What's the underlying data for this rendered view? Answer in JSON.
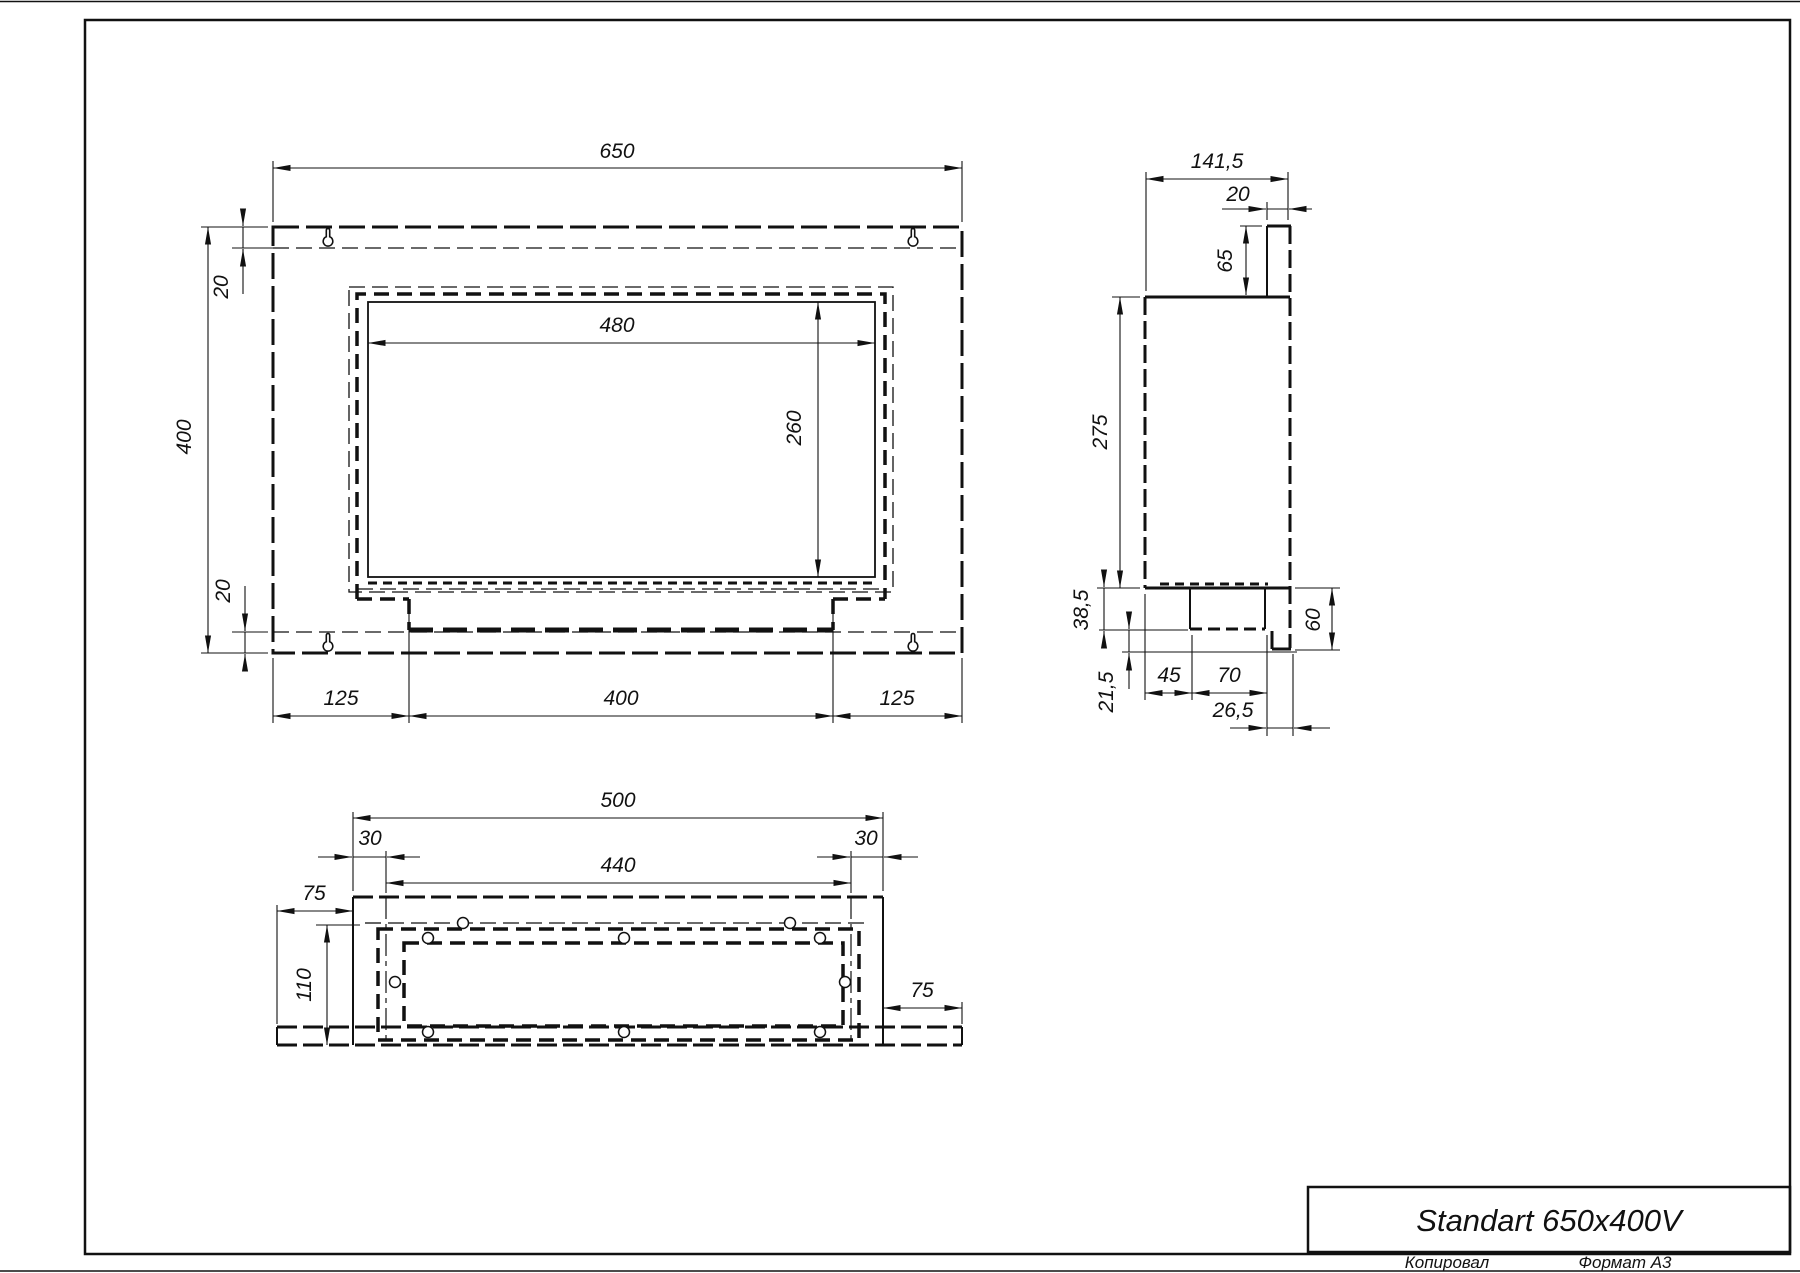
{
  "title_block": {
    "title": "Standart 650x400V",
    "copied_label": "Копировал",
    "format_label": "Формат А3"
  },
  "front_view": {
    "width": "650",
    "height": "400",
    "top_offset": "20",
    "bottom_offset": "20",
    "opening_width": "480",
    "opening_height": "260",
    "bottom_left_offset": "125",
    "bottom_tray_width": "400",
    "bottom_right_offset": "125"
  },
  "side_view": {
    "total_depth": "141,5",
    "flange_depth": "20",
    "flange_height": "65",
    "body_height": "275",
    "tray_height": "38,5",
    "lip_height": "21,5",
    "tray_left_offset": "45",
    "tray_width": "70",
    "lip_depth": "26,5",
    "lower_height": "60"
  },
  "bottom_view": {
    "body_width": "500",
    "left_offset": "30",
    "inner_width": "440",
    "right_offset": "30",
    "left_flange": "75",
    "depth": "110",
    "right_flange": "75"
  }
}
